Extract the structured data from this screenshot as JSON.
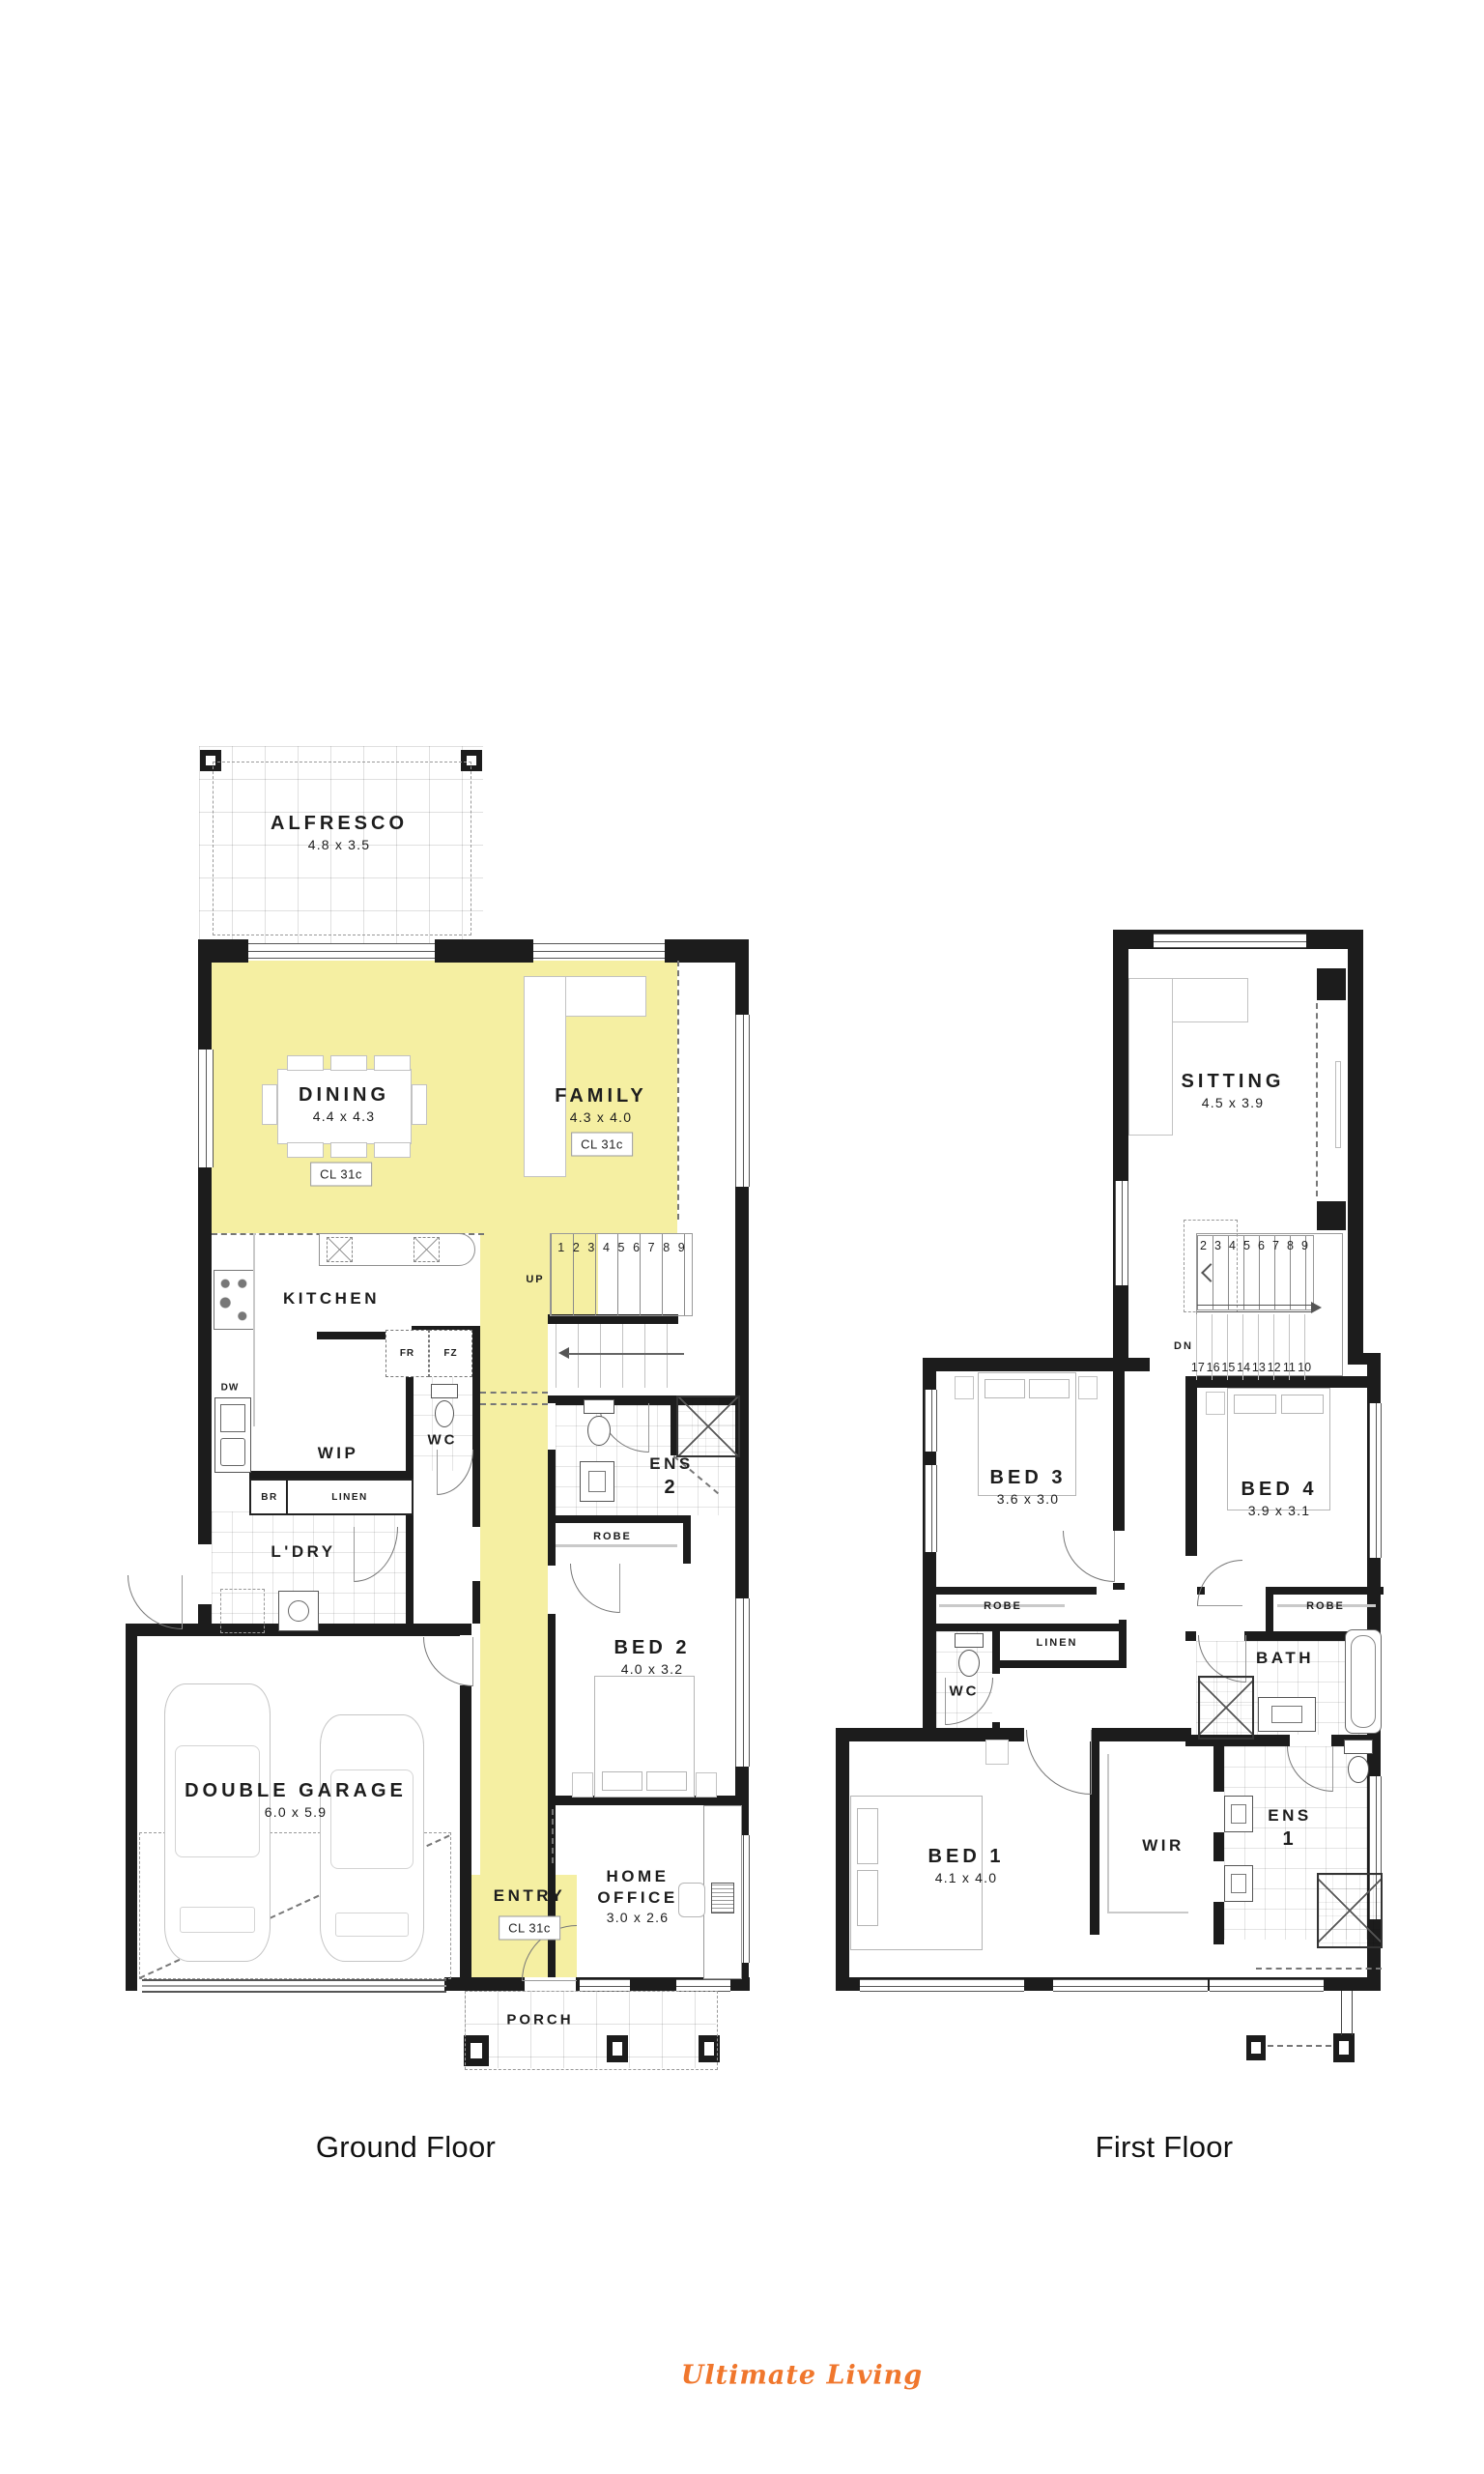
{
  "captions": {
    "ground": "Ground Floor",
    "first": "First Floor"
  },
  "logo": {
    "text": "Ultimate Living",
    "color": "#F0772D"
  },
  "colors": {
    "highlight": "#F5EFA2",
    "wall": "#1C1C1C"
  },
  "ground_floor": {
    "rooms": {
      "alfresco": {
        "name": "ALFRESCO",
        "size": "4.8 x 3.5"
      },
      "dining": {
        "name": "DINING",
        "size": "4.4 x 4.3",
        "ceiling": "CL 31c"
      },
      "family": {
        "name": "FAMILY",
        "size": "4.3 x 4.0",
        "ceiling": "CL 31c"
      },
      "kitchen": {
        "name": "KITCHEN"
      },
      "wip": {
        "name": "WIP"
      },
      "wc": {
        "name": "WC"
      },
      "laundry": {
        "name": "L'DRY"
      },
      "ens2": {
        "name": "ENS",
        "number": "2"
      },
      "bed2": {
        "name": "BED 2",
        "size": "4.0 x 3.2"
      },
      "garage": {
        "name": "DOUBLE GARAGE",
        "size": "6.0 x 5.9"
      },
      "entry": {
        "name": "ENTRY",
        "ceiling": "CL 31c"
      },
      "home_office": {
        "name": "HOME OFFICE",
        "size": "3.0 x 2.6"
      },
      "porch": {
        "name": "PORCH"
      }
    },
    "labels": {
      "fridge": "FR",
      "freezer": "FZ",
      "dishwasher": "DW",
      "broom": "BR",
      "linen": "LINEN",
      "robe": "ROBE",
      "up": "UP"
    },
    "stair_numbers": [
      "1",
      "2",
      "3",
      "4",
      "5",
      "6",
      "7",
      "8",
      "9"
    ]
  },
  "first_floor": {
    "rooms": {
      "sitting": {
        "name": "SITTING",
        "size": "4.5 x 3.9"
      },
      "bed3": {
        "name": "BED 3",
        "size": "3.6 x 3.0"
      },
      "bed4": {
        "name": "BED 4",
        "size": "3.9 x 3.1"
      },
      "wc": {
        "name": "WC"
      },
      "bath": {
        "name": "BATH"
      },
      "bed1": {
        "name": "BED 1",
        "size": "4.1 x 4.0"
      },
      "wir": {
        "name": "WIR"
      },
      "ens1": {
        "name": "ENS",
        "number": "1"
      }
    },
    "labels": {
      "robe_bed3": "ROBE",
      "robe_bed4": "ROBE",
      "linen": "LINEN",
      "down": "DN"
    },
    "stair_numbers_upper": [
      "2",
      "3",
      "4",
      "5",
      "6",
      "7",
      "8",
      "9"
    ],
    "stair_numbers_lower": [
      "17",
      "16",
      "15",
      "14",
      "13",
      "12",
      "11",
      "10"
    ]
  }
}
